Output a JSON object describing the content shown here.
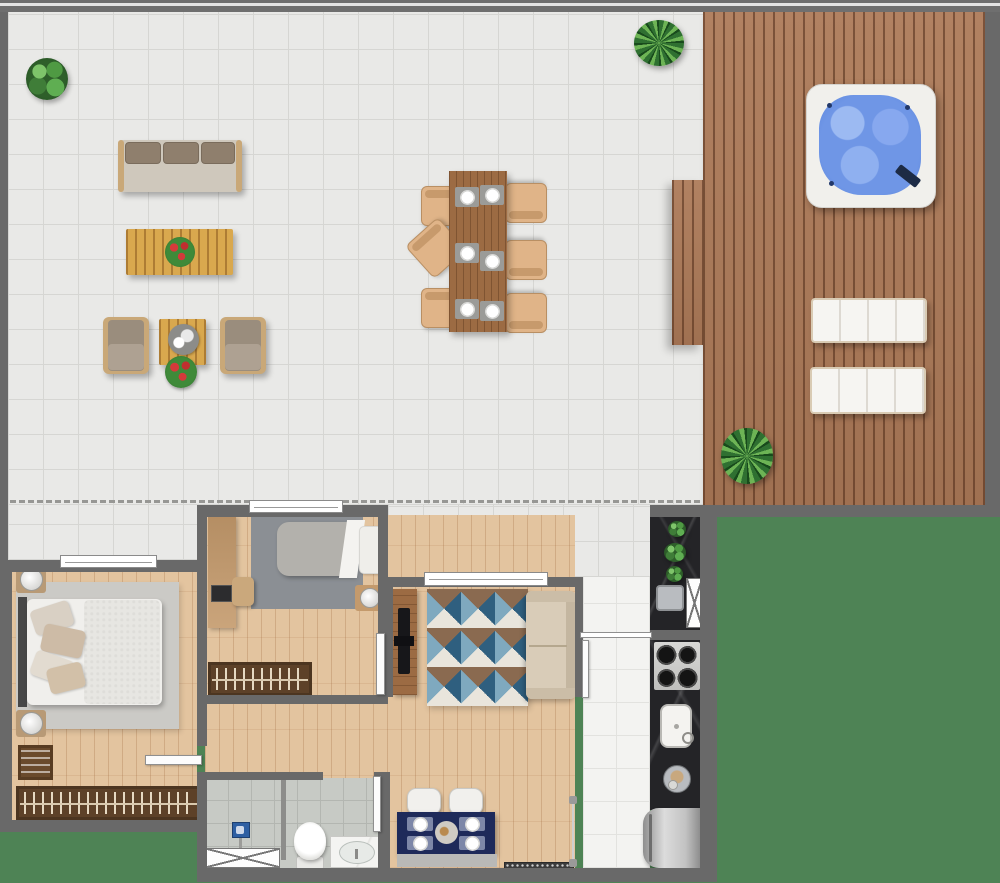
{
  "scene": {
    "type": "apartment-floor-plan-top-view",
    "canvas": {
      "width": 1000,
      "height": 883
    },
    "background_color": "#4e8355"
  },
  "palette": {
    "surround_green": "#4e8355",
    "wall_gray": "#696969",
    "terrace_tile": "#e9e9e7",
    "hall_tile": "#f3f3f1",
    "bathroom_tile": "#c7cac5",
    "deck_wood": "#ad7a58",
    "interior_wood": "#e3c49f",
    "kitchen_counter_marble": "#242427",
    "jacuzzi_water": "#6f96e6",
    "navy_table": "#1e2a5a",
    "sofa_beige": "#d9ccb8",
    "wardrobe_brown": "#5d4128",
    "rug_light_gray": "#cbcac6",
    "rug_dark_gray": "#8b8f94",
    "shower_head_blue": "#2e5fa3",
    "fridge_steel": "#c0c0c0"
  },
  "rooms": {
    "terrace": {
      "floor": "light-gray-tiles",
      "furniture": [
        "potted-plant",
        "outdoor-sofa-3-seat",
        "slatted-coffee-table-with-red-plant",
        "armchair-left",
        "armchair-right",
        "slatted-side-table-with-tray",
        "flower-planter",
        "dining-table-6-settings",
        "dining-chairs-x6-one-pulled-out",
        "palm-plant"
      ],
      "boundary_marker": "dashed-line"
    },
    "deck": {
      "floor": "wood-planks",
      "furniture": [
        "jacuzzi-hot-tub",
        "sun-lounger-upper",
        "sun-lounger-lower",
        "palm-plant"
      ]
    },
    "master_bedroom": {
      "floor": "wood",
      "furniture": [
        "double-bed-with-pillows",
        "area-rug",
        "nightstand-with-lamp-top",
        "nightstand-with-lamp-bottom",
        "dresser",
        "wardrobe-with-clothes",
        "window",
        "door"
      ]
    },
    "second_bedroom": {
      "floor": "wood",
      "furniture": [
        "single-bed",
        "area-rug",
        "desk-with-laptop",
        "desk-chair",
        "nightstand-with-lamp",
        "wardrobe-with-clothes",
        "window",
        "door"
      ]
    },
    "living_room": {
      "floor": "wood",
      "furniture": [
        "geometric-triangle-rug",
        "sofa",
        "tv-console-with-tv",
        "window"
      ]
    },
    "dining_nook": {
      "floor": "wood",
      "furniture": [
        "navy-table-4-settings",
        "chair-left",
        "chair-right",
        "bench",
        "entry-doormat",
        "glass-partition"
      ]
    },
    "kitchen": {
      "floor": "white-tiles",
      "furniture": [
        "counter-with-plants",
        "steel-sink",
        "tall-cabinet-x-symbol",
        "cooktop-4-burners",
        "white-sink-with-faucet",
        "round-basin",
        "refrigerator"
      ]
    },
    "bathroom": {
      "floor": "gray-tiles",
      "furniture": [
        "shower-area-with-head",
        "shower-sill-x-symbol",
        "toilet",
        "vanity-with-oval-sink",
        "door"
      ]
    }
  }
}
